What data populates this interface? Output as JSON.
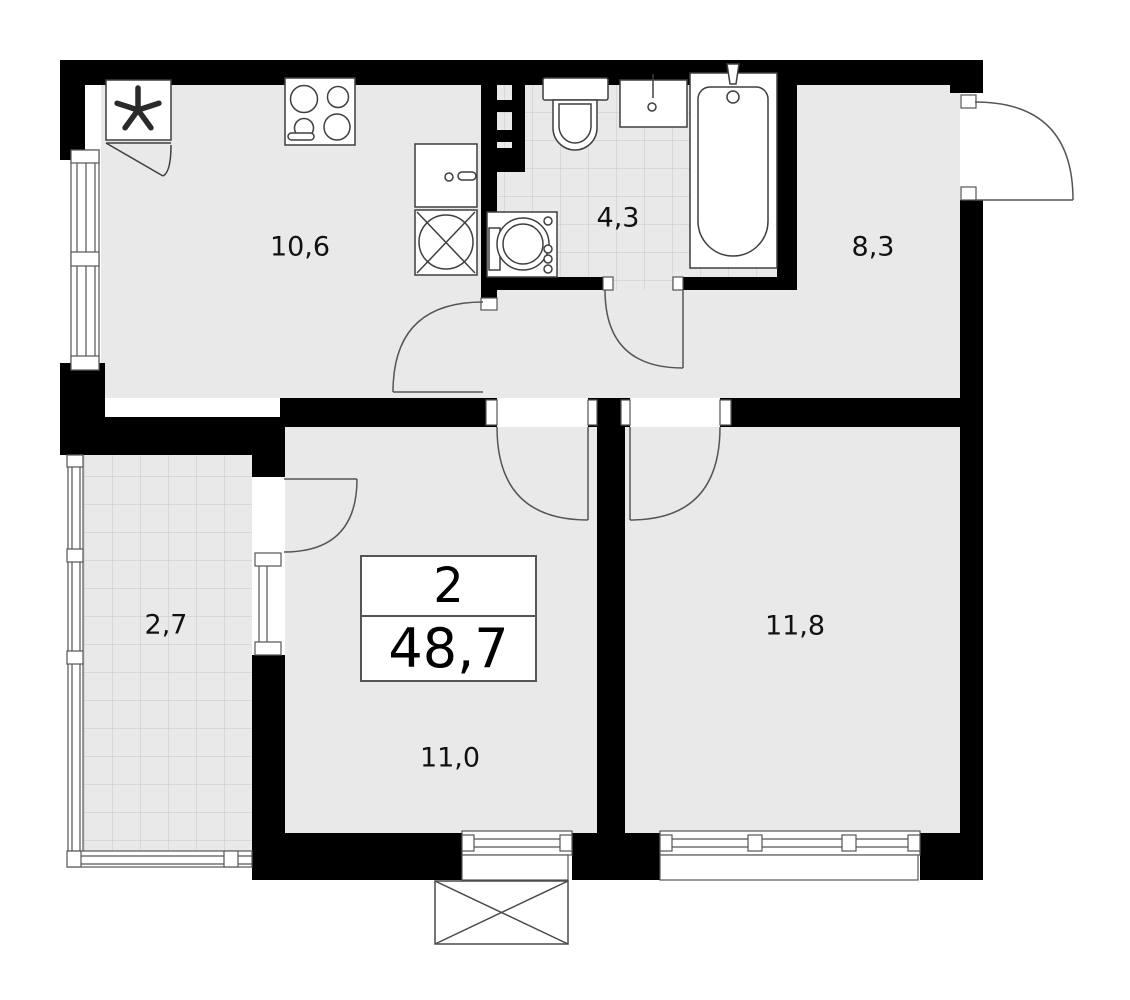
{
  "plan": {
    "summary": {
      "rooms_count": "2",
      "total_area": "48,7"
    },
    "rooms": {
      "kitchen": {
        "label": "10,6"
      },
      "bathroom": {
        "label": "4,3"
      },
      "hallway": {
        "label": "8,3"
      },
      "balcony": {
        "label": "2,7"
      },
      "living_room": {
        "label": "11,0"
      },
      "bedroom": {
        "label": "11,8"
      }
    },
    "colors": {
      "wall": "#000000",
      "floor": "#e9e9e9",
      "tile_line": "#c6c6c6",
      "fixture_stroke": "#3f3f3f",
      "door_stroke": "#555555"
    }
  }
}
